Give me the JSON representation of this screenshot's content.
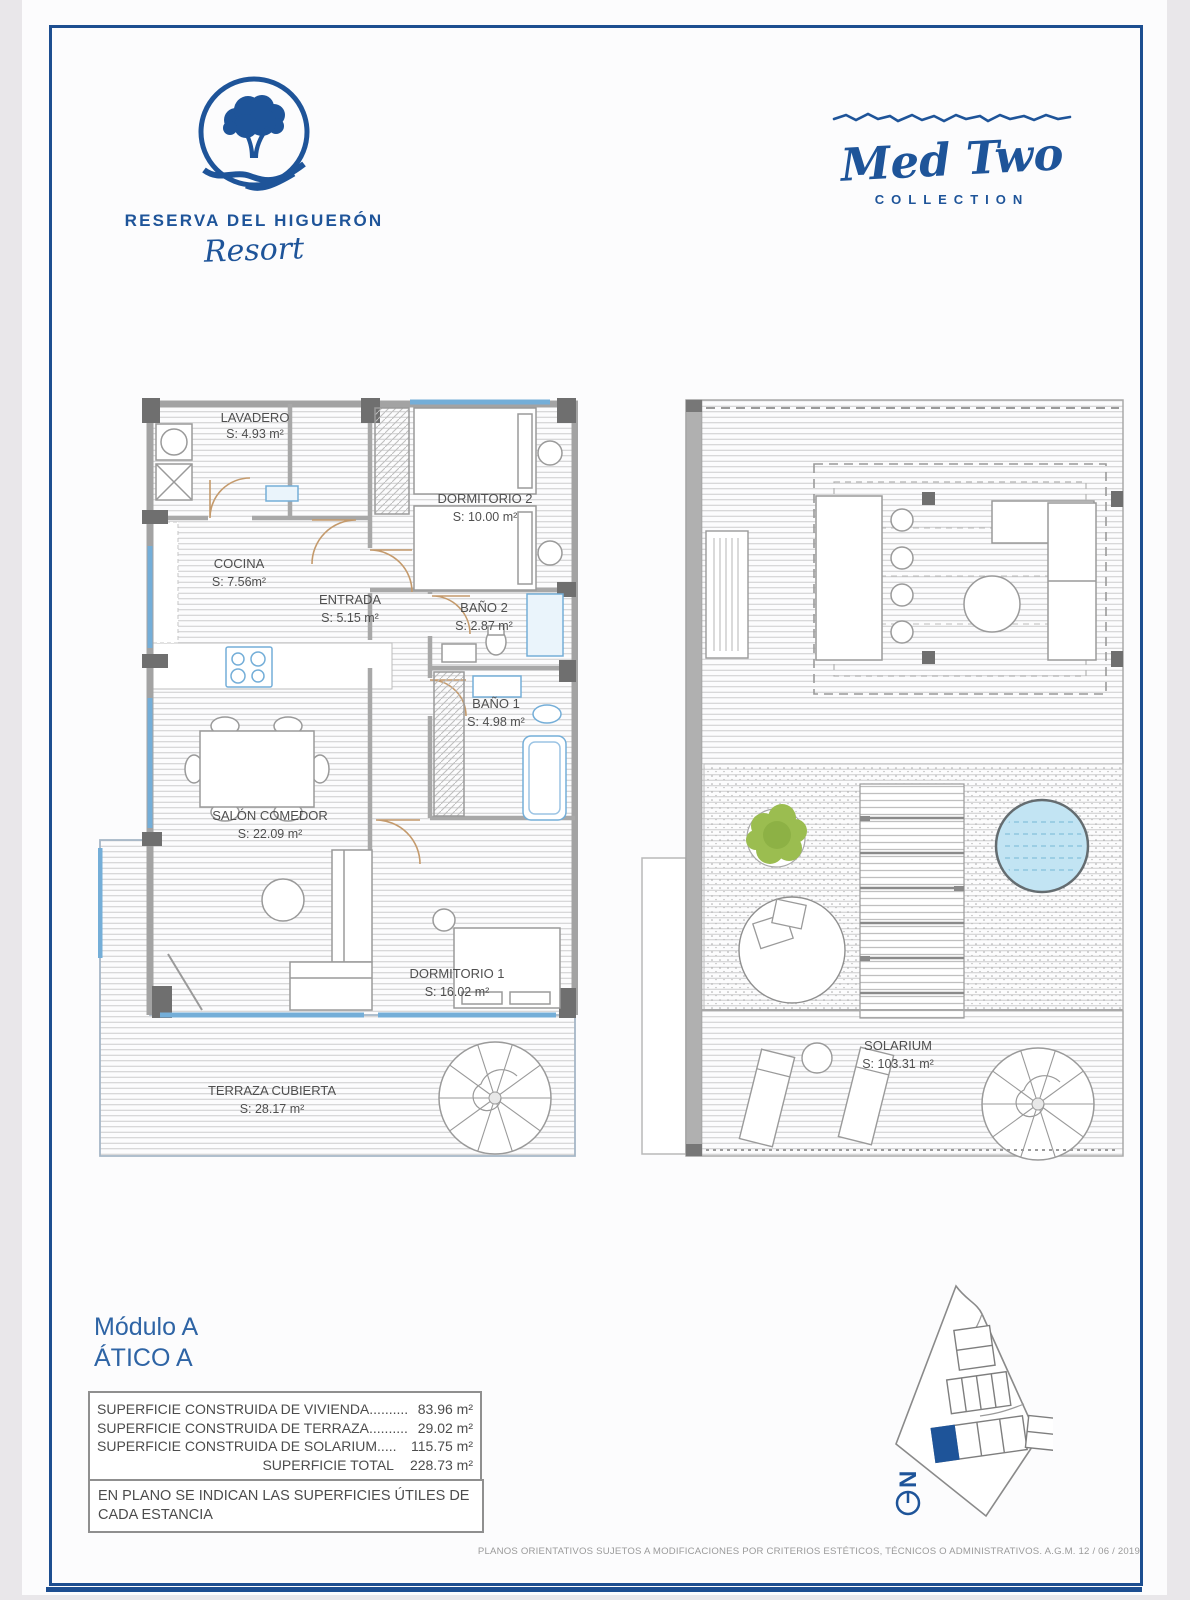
{
  "brand": {
    "name": "RESERVA DEL HIGUERÓN",
    "tagline": "Resort"
  },
  "collection": {
    "name": "Med Two",
    "label": "COLLECTION"
  },
  "floor_plans": {
    "apartment": {
      "rooms": [
        {
          "label": "LAVADERO",
          "area": "S: 4.93 m²"
        },
        {
          "label": "DORMITORIO 2",
          "area": "S: 10.00 m²"
        },
        {
          "label": "COCINA",
          "area": "S: 7.56m²"
        },
        {
          "label": "ENTRADA",
          "area": "S: 5.15 m²"
        },
        {
          "label": "BAÑO 2",
          "area": "S: 2.87 m²"
        },
        {
          "label": "BAÑO 1",
          "area": "S: 4.98 m²"
        },
        {
          "label": "SALÓN COMEDOR",
          "area": "S: 22.09 m²"
        },
        {
          "label": "DORMITORIO 1",
          "area": "S: 16.02 m²"
        },
        {
          "label": "TERRAZA CUBIERTA",
          "area": "S: 28.17 m²"
        }
      ]
    },
    "solarium": {
      "rooms": [
        {
          "label": "SOLARIUM",
          "area": "S: 103.31 m²"
        }
      ]
    }
  },
  "unit": {
    "module": "Módulo A",
    "name": "ÁTICO A"
  },
  "surfaces": {
    "rows": [
      {
        "label": "SUPERFICIE CONSTRUIDA DE VIVIENDA..........",
        "value": "83.96 m²"
      },
      {
        "label": "SUPERFICIE CONSTRUIDA DE TERRAZA..........",
        "value": "29.02 m²"
      },
      {
        "label": "SUPERFICIE CONSTRUIDA DE SOLARIUM.....",
        "value": "115.75 m²"
      }
    ],
    "total": {
      "label": "SUPERFICIE TOTAL",
      "value": "228.73 m²"
    }
  },
  "note": "EN PLANO SE INDICAN LAS SUPERFICIES ÚTILES DE CADA ESTANCIA",
  "compass": {
    "label": "N"
  },
  "footer": "PLANOS ORIENTATIVOS SUJETOS A MODIFICACIONES POR CRITERIOS ESTÉTICOS, TÉCNICOS O ADMINISTRATIVOS. A.G.M.  12 / 06 / 2019",
  "colors": {
    "brand_blue": "#1e5499",
    "frame_blue": "#1d4e90",
    "title_blue": "#2e64a5",
    "wall_gray": "#a9a9a9",
    "column_gray": "#6f6f6f",
    "door_tan": "#c49a6c",
    "window_blue": "#74aed8",
    "pool_blue": "#c2e4f3",
    "plant_green": "#9bbd50"
  }
}
